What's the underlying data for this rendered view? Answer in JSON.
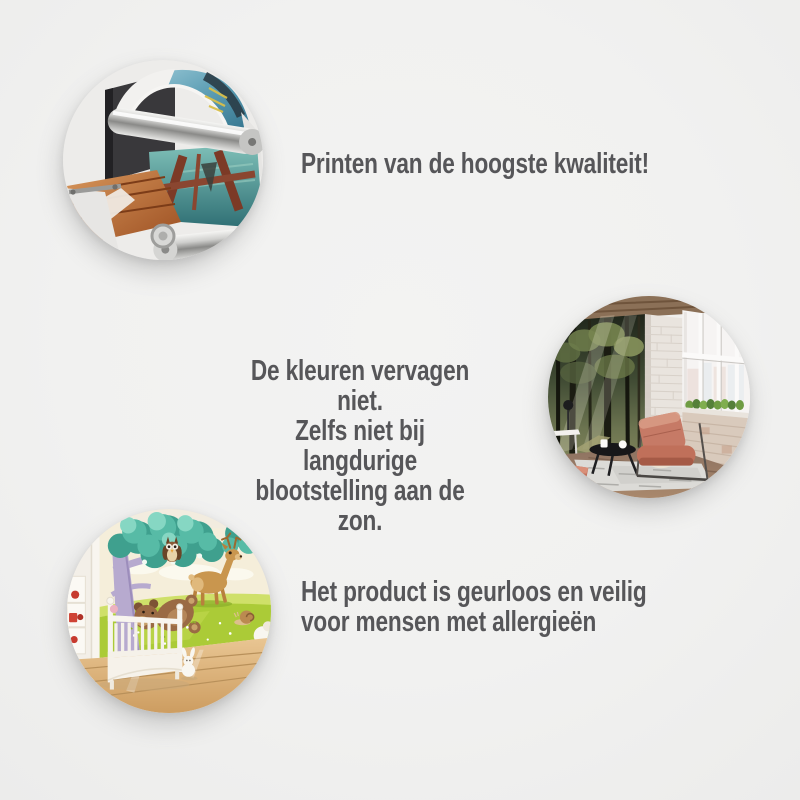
{
  "canvas": {
    "background_color": "#f1f1f0",
    "caption_color": "#565659"
  },
  "features": [
    {
      "image": "large-format-printer-closeup-photo",
      "text": "Printen van de hoogste kwaliteit!"
    },
    {
      "image": "living-room-forest-wall-mural-photo",
      "lines": [
        "De kleuren vervagen niet.",
        "Zelfs niet bij langdurige",
        "blootstelling aan de zon."
      ]
    },
    {
      "image": "nursery-cartoon-wall-mural-photo",
      "lines": [
        "Het product is geurloos en veilig",
        "voor mensen met allergieën"
      ]
    }
  ]
}
